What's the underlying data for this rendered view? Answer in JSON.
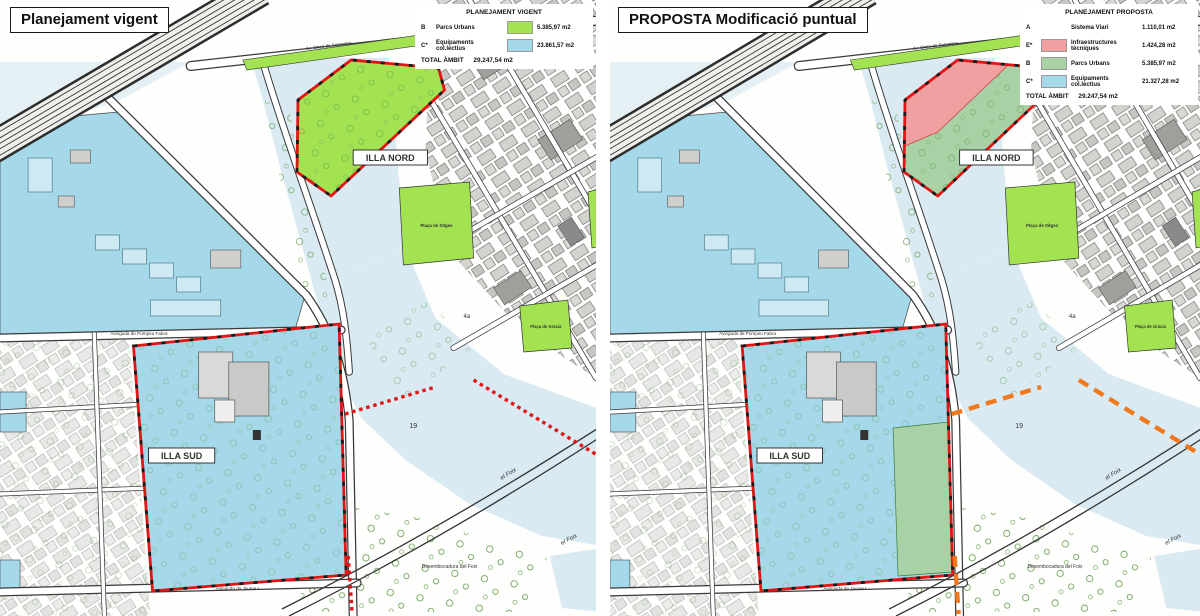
{
  "panels": {
    "left": {
      "title": "Planejament vigent",
      "legend": {
        "title": "PLANEJAMENT VIGENT",
        "rows": [
          {
            "code": "B",
            "label": "Parcs Urbans",
            "value": "5.385,97 m2"
          },
          {
            "code": "C*",
            "label": "Equipaments col.lectius",
            "value": "23.861,57 m2"
          }
        ],
        "total_label": "TOTAL ÀMBIT",
        "total_value": "29.247,54 m2"
      }
    },
    "right": {
      "title": "PROPOSTA Modificació puntual",
      "legend": {
        "title": "PLANEJAMENT PROPOSTA",
        "rows": [
          {
            "code": "A",
            "label": "Sistema Viari",
            "value": "1.110,01 m2"
          },
          {
            "code": "E*",
            "label": "Infraestructures tècniques",
            "value": "1.424,28 m2"
          },
          {
            "code": "B",
            "label": "Parcs Urbans",
            "value": "5.385,97 m2"
          },
          {
            "code": "C*",
            "label": "Equipaments col.lectius",
            "value": "21.327,28 m2"
          }
        ],
        "total_label": "TOTAL ÀMBIT",
        "total_value": "29.247,54 m2"
      }
    }
  },
  "map_labels": {
    "illa_nord": "ILLA NORD",
    "illa_sud": "ILLA SUD",
    "el_foix": "el Foix",
    "desembocadura": "Desembocadura del Foix",
    "av_onze": "Av. Onze de Setembre",
    "av_pompeu": "Avinguda de Pompeu Fabra",
    "av_jaume": "Avinguda de Jaume I",
    "placa_sitges": "Plaça de Sitges",
    "placa_gracia": "Plaça de Gràcia",
    "num_19": "19",
    "num_4a": "4a"
  },
  "colors": {
    "vigent_parcs_green": "#a3e352",
    "proposta_parcs_green": "#a8d2a6",
    "infraestructures_pink": "#f0a0a0",
    "equipaments_blue": "#a5d8e8",
    "river_blue": "#d9eaf2",
    "ambit_border_red": "#e21414",
    "vigent_ambit_line_red": "#e21414",
    "proposta_ambit_line_orange": "#f0791e"
  }
}
